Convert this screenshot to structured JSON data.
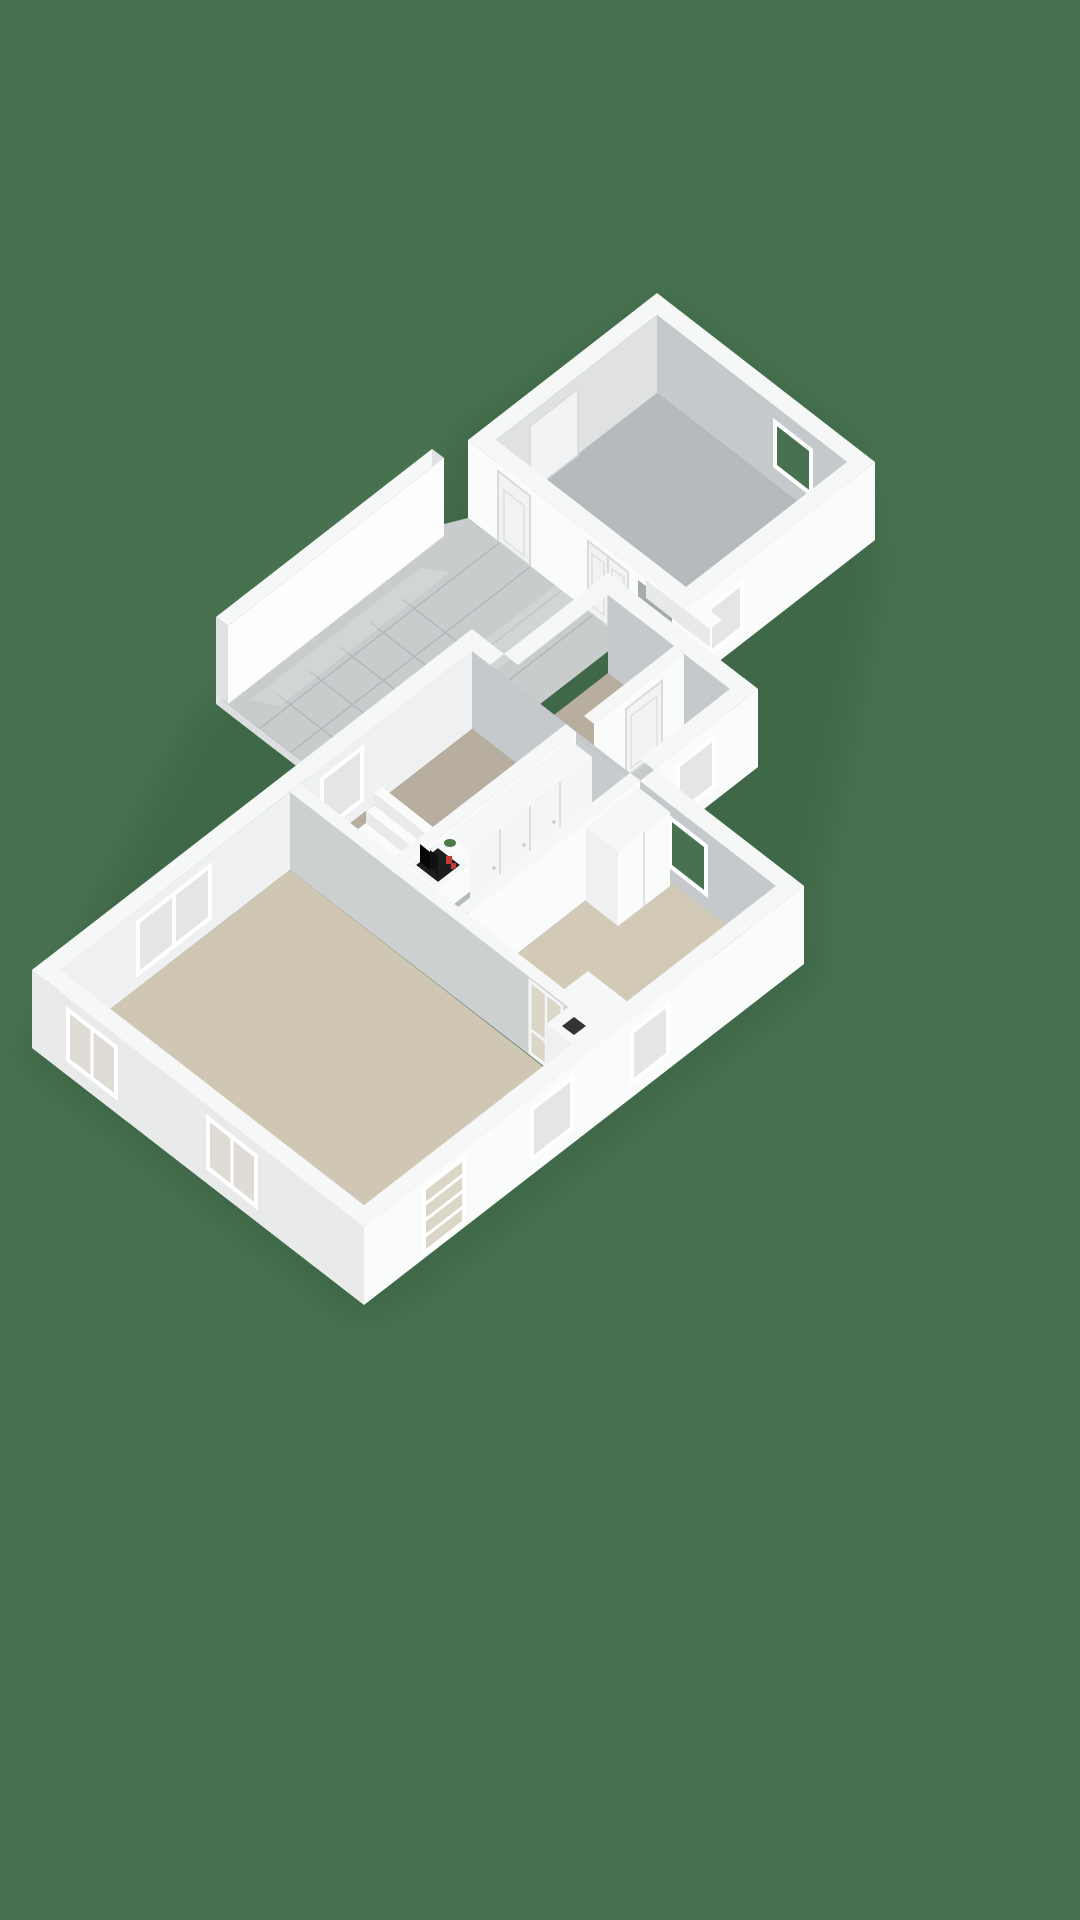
{
  "meta": {
    "view": "3d-floorplan-isometric",
    "background": "solid green chroma backdrop",
    "text_visible": "none"
  },
  "palette": {
    "background_green": "#47714F",
    "wall_top": "#f6f7f7",
    "wall_bright": "#fafbfb",
    "wall_light": "#eef0f1",
    "wall_mid": "#dfe1e2",
    "wall_shadow": "#c6c9cb",
    "wall_deep": "#b9bcbe",
    "floor_gray": "#b7babc",
    "floor_tile": "#c9cccd",
    "tile_line": "#b2b5b7",
    "floor_beige": "#cfc7b3",
    "floor_taupe": "#b8ae9f",
    "stove_black": "#1b1c1d",
    "burner_red": "#cf3730",
    "boiler_dark": "#1c1d1e",
    "accent_red": "#c03b34",
    "plant_green": "#4e7a44",
    "glass_pale": "#e4e6e6",
    "shadow_green": "#10301c"
  },
  "scene": {
    "rooms": [
      {
        "name": "garage",
        "floor": "gray screed",
        "features": [
          "window ne wall",
          "window se wall",
          "double panel door",
          "single panel door",
          "interior steps"
        ]
      },
      {
        "name": "breezeway",
        "floor": "glossy tiles",
        "features": [
          "freestanding privacy wall",
          "open terrace edge"
        ]
      },
      {
        "name": "entry-wing",
        "floor": "tiles",
        "features": [
          "interior panel door",
          "side window",
          "bathroom"
        ]
      },
      {
        "name": "hallway",
        "floor": "gray",
        "features": [
          "built-in wardrobes",
          "boiler closet with red valves",
          "small green plant"
        ]
      },
      {
        "name": "bedroom",
        "floor": "taupe carpet",
        "features": [
          "staircase five treads",
          "window nw wall"
        ]
      },
      {
        "name": "living-room",
        "floor": "beige",
        "features": [
          "double window nw",
          "two windows sw",
          "glazed patio door se",
          "glazed interior door",
          "chimney column"
        ]
      },
      {
        "name": "kitchen",
        "floor": "beige",
        "features": [
          "island counter",
          "cooktop four red burners",
          "sink",
          "oven cabinet",
          "tall cabinets",
          "dark appliance",
          "window to outside"
        ]
      }
    ],
    "cooktop_burner_count": 4
  }
}
